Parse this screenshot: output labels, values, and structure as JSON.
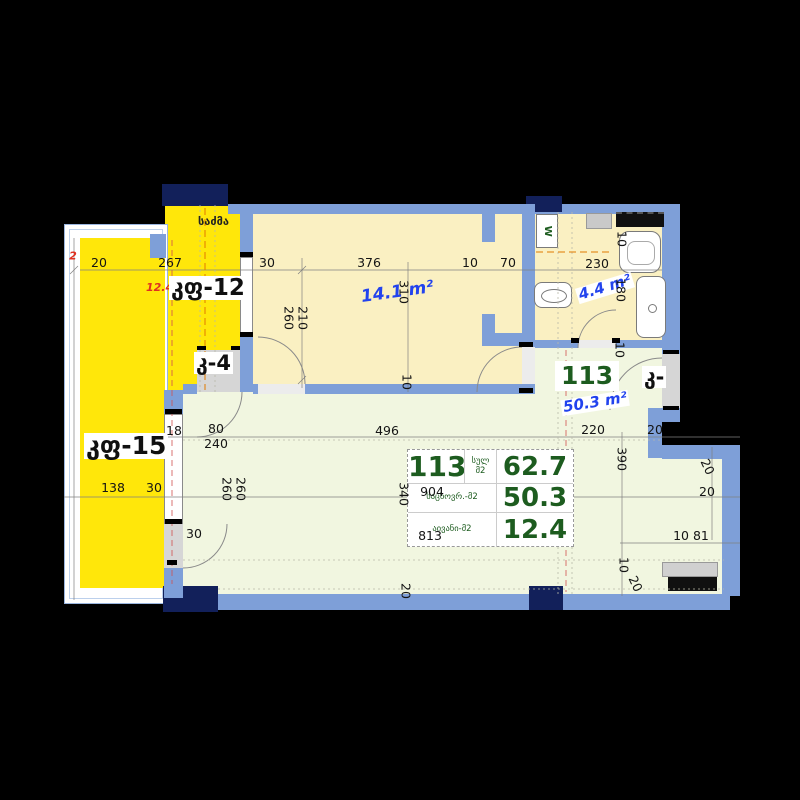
{
  "labels": {
    "strip_top": "საძმა",
    "strip_name": "კფ-12",
    "strip_area": "12.4",
    "door_k4": "კ-4",
    "balcony_name": "კფ-15",
    "door_right": "კ-",
    "room_area": "14.1 m²",
    "bath_area": "4.4 m²",
    "hall_number": "113",
    "hall_area": "50.3 m²",
    "washer": "W"
  },
  "table": {
    "unit": "113",
    "total_label_1": "სულ",
    "total_label_2": "მ2",
    "total_value": "62.7",
    "living_label": "საცხოვრ.-მ2",
    "living_value": "50.3",
    "balcony_label": "აივანი-მ2",
    "balcony_value": "12.4"
  },
  "dims": [
    {
      "t": "20",
      "x": 99,
      "y": 263
    },
    {
      "t": "267",
      "x": 170,
      "y": 263
    },
    {
      "t": "30",
      "x": 267,
      "y": 263
    },
    {
      "t": "376",
      "x": 369,
      "y": 263
    },
    {
      "t": "10",
      "x": 470,
      "y": 263
    },
    {
      "t": "70",
      "x": 508,
      "y": 263
    },
    {
      "t": "230",
      "x": 597,
      "y": 264
    },
    {
      "t": "10",
      "x": 621,
      "y": 239,
      "r": 90
    },
    {
      "t": "180",
      "x": 620,
      "y": 290,
      "r": 90
    },
    {
      "t": "10",
      "x": 619,
      "y": 350,
      "r": 90
    },
    {
      "t": "260",
      "x": 288,
      "y": 318,
      "r": 90
    },
    {
      "t": "210",
      "x": 302,
      "y": 318,
      "r": 90
    },
    {
      "t": "310",
      "x": 403,
      "y": 292,
      "r": 90
    },
    {
      "t": "10",
      "x": 406,
      "y": 382,
      "r": 90
    },
    {
      "t": "2",
      "x": 73,
      "y": 256,
      "red": true
    },
    {
      "t": "18",
      "x": 174,
      "y": 431
    },
    {
      "t": "80",
      "x": 216,
      "y": 429
    },
    {
      "t": "240",
      "x": 216,
      "y": 444
    },
    {
      "t": "496",
      "x": 387,
      "y": 431
    },
    {
      "t": "220",
      "x": 593,
      "y": 430
    },
    {
      "t": "20",
      "x": 655,
      "y": 430
    },
    {
      "t": "260",
      "x": 226,
      "y": 489,
      "r": 90
    },
    {
      "t": "260",
      "x": 240,
      "y": 489,
      "r": 90
    },
    {
      "t": "30",
      "x": 194,
      "y": 534
    },
    {
      "t": "138",
      "x": 113,
      "y": 488
    },
    {
      "t": "30",
      "x": 154,
      "y": 488
    },
    {
      "t": "340",
      "x": 403,
      "y": 494,
      "r": 90
    },
    {
      "t": "904",
      "x": 432,
      "y": 492
    },
    {
      "t": "813",
      "x": 430,
      "y": 536
    },
    {
      "t": "390",
      "x": 621,
      "y": 459,
      "r": 90
    },
    {
      "t": "20",
      "x": 707,
      "y": 467,
      "r": 65
    },
    {
      "t": "20",
      "x": 707,
      "y": 492
    },
    {
      "t": "10 81",
      "x": 691,
      "y": 536
    },
    {
      "t": "10",
      "x": 623,
      "y": 565,
      "r": 90
    },
    {
      "t": "20",
      "x": 635,
      "y": 584,
      "r": 65
    },
    {
      "t": "20",
      "x": 405,
      "y": 591,
      "r": 90
    }
  ],
  "colors": {
    "wall": "#7e9fd8",
    "column": "#12205a",
    "balcony_fill": "#ffe70a",
    "room_fill": "#faf0c2",
    "living_fill": "#f1f6e0",
    "accent_green": "#1d5c1f",
    "accent_blue": "#2243ee",
    "accent_red": "#e03020"
  }
}
